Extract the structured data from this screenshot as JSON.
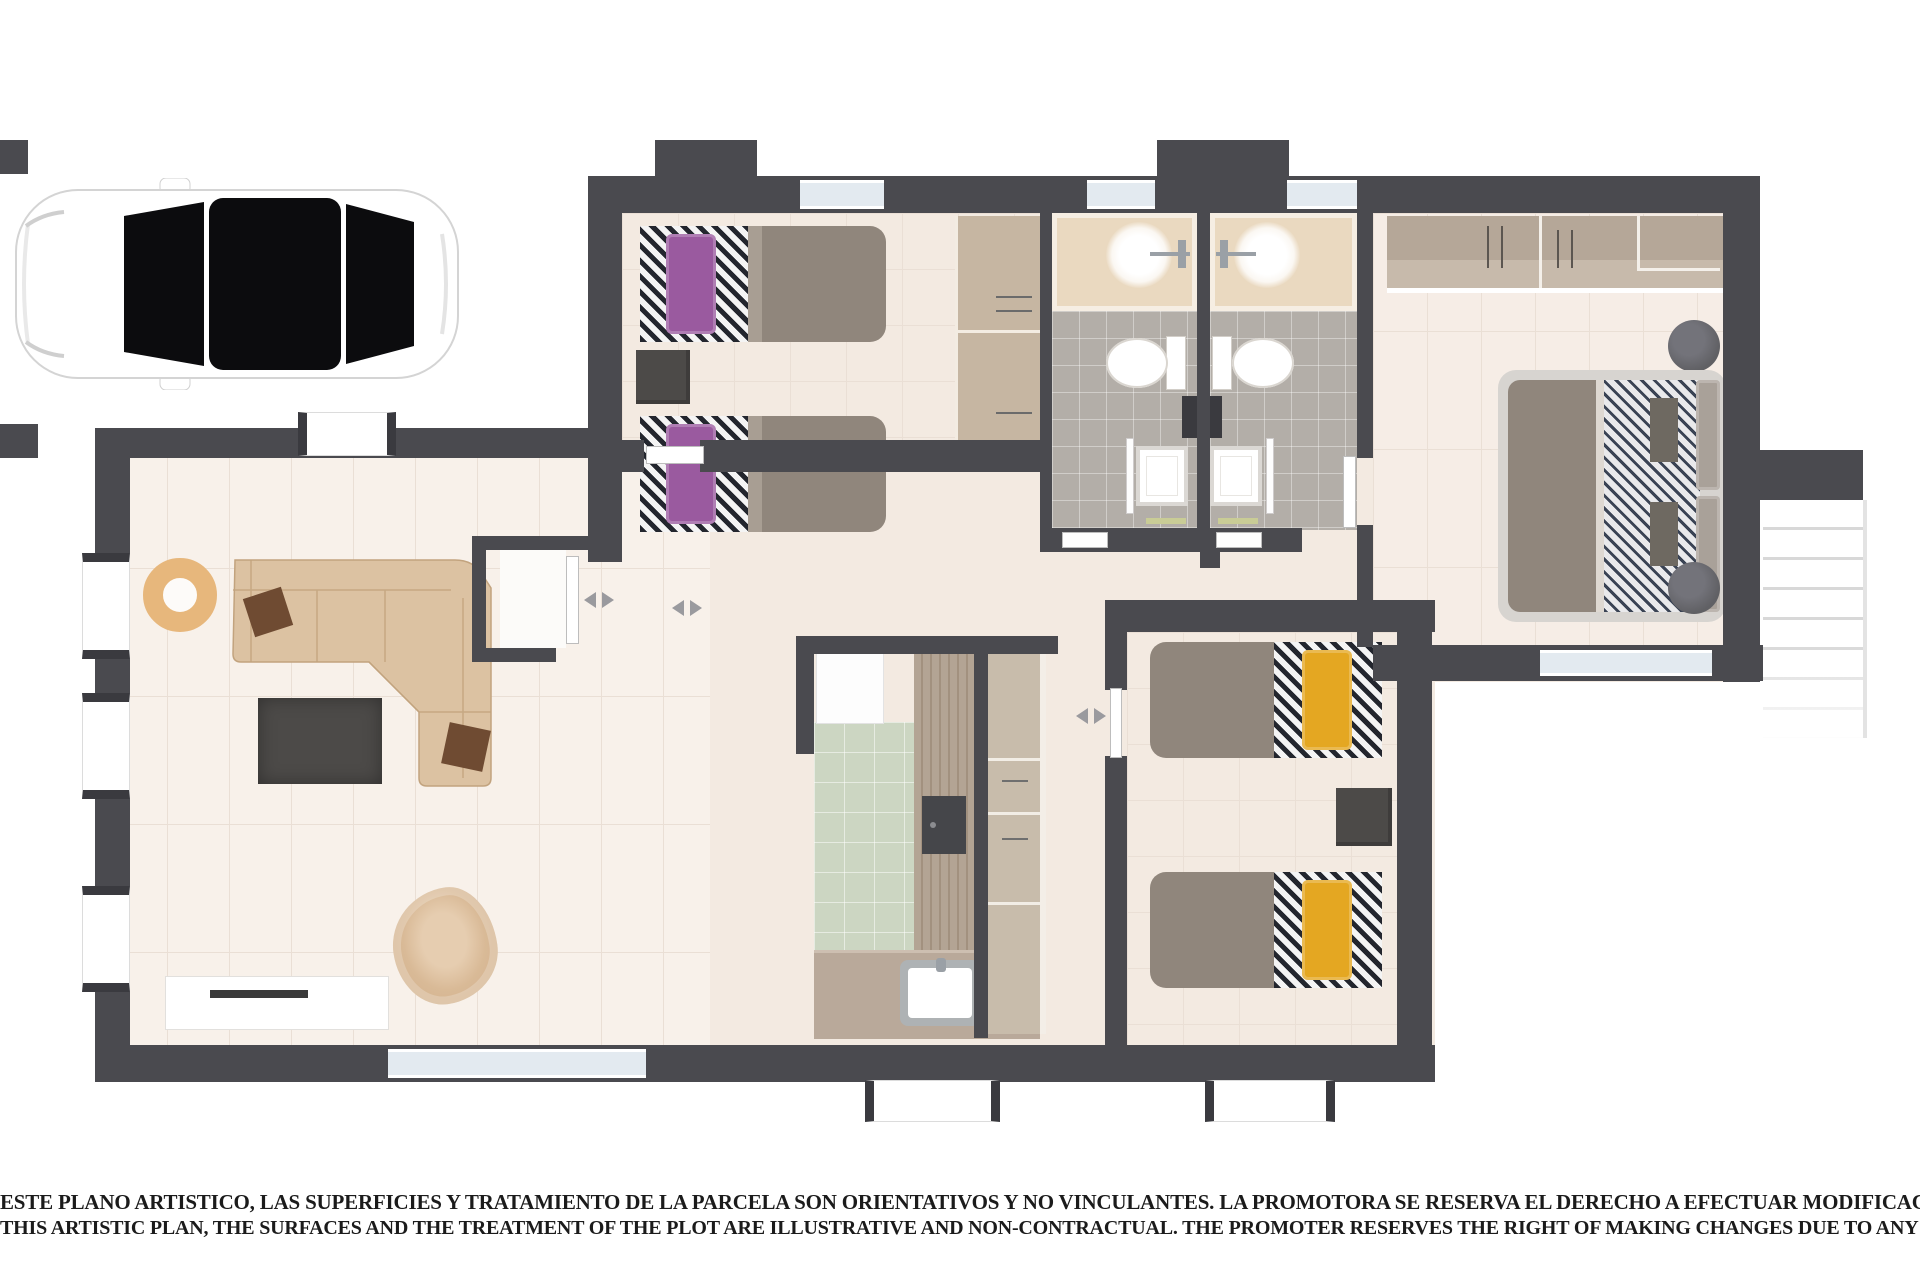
{
  "disclaimer": {
    "line_es": "ESTE PLANO ARTISTICO, LAS SUPERFICIES Y TRATAMIENTO DE LA PARCELA SON ORIENTATIVOS Y NO VINCULANTES. LA PROMOTORA SE RESERVA EL DERECHO A EFECTUAR MODIFICACIONES POR CUALQUIER NECESIDAD",
    "line_en": "THIS ARTISTIC PLAN, THE SURFACES AND THE TREATMENT OF THE PLOT ARE ILLUSTRATIVE AND NON-CONTRACTUAL. THE PROMOTER RESERVES THE RIGHT OF MAKING CHANGES DUE TO ANY NECESSITY"
  },
  "colors": {
    "wall": "#4a4a4f",
    "wall_dark": "#3a3a3f",
    "floor_room": "#f3eae1",
    "floor_living": "#f8f1ea",
    "floor_master": "#f6ede6",
    "floor_bath": "#b3aea8",
    "floor_kitchen": "#ccd6c2",
    "grid_line": "#eadfd5",
    "vanity": "#ead9c0",
    "wood": "#b3a494",
    "wood_light": "#c8bcab",
    "counter": "#b9a99a",
    "wardrobe": "#c6b6a2",
    "closet_top": "#b5a798",
    "closet_low": "#c7baab",
    "sofa": "#dcc2a2",
    "sofa_line": "#c2a37e",
    "pillow_brown": "#6f4b32",
    "accent_purple": "#9a5a9f",
    "accent_yellow": "#e4a722",
    "bed_gray": "#90867c",
    "bed_fold": "#a89e93",
    "frame_gray": "#d7d4d0",
    "stripe_dark": "#23262e",
    "table_dark": "#4c4a48",
    "stool": "#606064",
    "glass": "#e3eaf0",
    "stair_line": "#d8d8d8",
    "towel": "#c9cc96",
    "car_body": "#ffffff",
    "car_glass": "#0c0c0e",
    "text": "#1b1b1b"
  }
}
